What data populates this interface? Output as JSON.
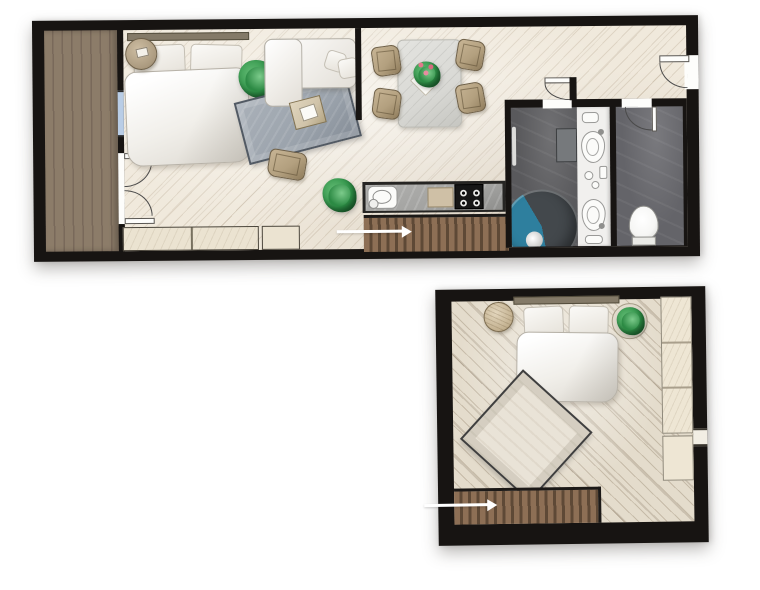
{
  "document": {
    "type": "apartment floor plan illustration",
    "page_background": "#ffffff",
    "visible_text": "none — purely graphical plan with direction arrows"
  },
  "colors": {
    "page": "#ffffff",
    "wall": "#171412",
    "floor-main": "#f0e9dc",
    "floor-upper": "#e4dccc",
    "deck": "#8c7c69",
    "deck-stroke": "#79695a",
    "stairs": "#8d6f55",
    "stairs-gap": "#5e4936",
    "bath-floor": "#59595c",
    "wc-floor": "#646469",
    "vanity": "#f1f0ee",
    "shower-dark": "#45494d",
    "shower-blue": "#2e7f9e",
    "toilet": "#f6f6f4",
    "window": "#b9cde6",
    "door": "#fdfdfb",
    "arc": "#4a4a4a",
    "rug": "#9ba3ac",
    "rug-border": "#525a64",
    "rug-upper": "#e9e3d7",
    "tan": "#b3a07f",
    "plant": "#2f9348",
    "plant-light": "#63bb74",
    "counter": "#a3a3a1",
    "stove": "#161616",
    "board": "#cfc0a6",
    "bench": "#ebe3d1",
    "wardrobe": "#eee6d4",
    "headboard": "#847a68",
    "table": "#d9d9d5",
    "coffee": "#d0c3a9",
    "fixture-border": "#9a9a98",
    "arrow": "#ffffff"
  },
  "plans": [
    {
      "id": "main-floor",
      "rooms": [
        "balcony",
        "bedroom-living-area",
        "dining-area",
        "kitchen",
        "hallway",
        "bathroom",
        "wc"
      ],
      "furniture": [
        "double-bed",
        "bedside-table",
        "potted-plants",
        "sofa-with-cushions",
        "living-rug",
        "coffee-table",
        "armchair",
        "dining-table-with-centerpiece",
        "four-dining-chairs",
        "kitchen-counter-sink-cooktop",
        "staircase",
        "low-benches",
        "round-shower",
        "double-sink-vanity",
        "toilet",
        "balcony-french-doors",
        "entrance-door"
      ],
      "stair_arrow_direction": "right"
    },
    {
      "id": "upper-floor",
      "rooms": [
        "bedroom"
      ],
      "furniture": [
        "double-bed",
        "round-side-table",
        "potted-plant",
        "diamond-rug",
        "wardrobe-wall-unit",
        "staircase"
      ],
      "stair_arrow_direction": "right"
    }
  ]
}
